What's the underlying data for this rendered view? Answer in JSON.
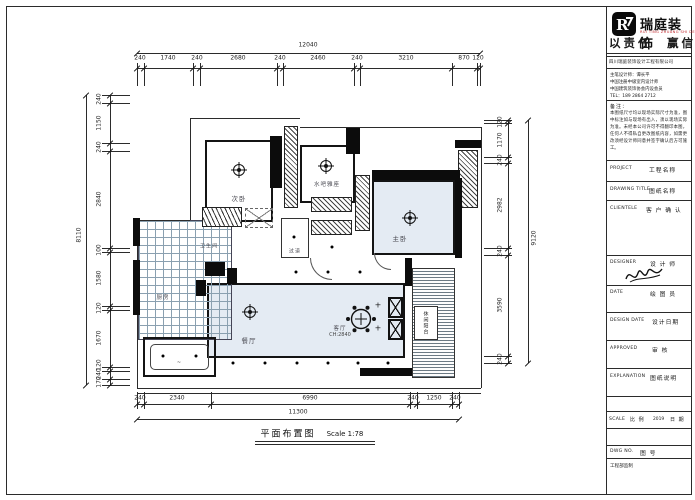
{
  "colors": {
    "room_fill": "#e4ebf3",
    "line": "#1a1a1a",
    "brand_red": "#c1272d"
  },
  "brand": {
    "name": "瑞庭装饰",
    "sub": "RUI TING ZHUANG SHI DECORATION",
    "slogan": "以责任　赢信任",
    "company": "四川瑞庭装饰设计工程有限公司",
    "info": [
      "主笔设计师：谭长平",
      "中国注册中级室内设计师",
      "中国建筑装饰协会内设会员",
      "TEL：189 2864 2712"
    ]
  },
  "titleblock": {
    "notes_label": "备注：",
    "notes": "本图纸尺寸均以现场实际尺寸为准，图中标注如与现场有出入，须以现场实际为准。未经本公司许可不得翻印本图，任何人不得私自更改图纸内容，如需更改须经设计师同意并签字确认后方可施工。",
    "rows": [
      {
        "en": "PROJECT",
        "cn": "工程名称"
      },
      {
        "en": "DRAWING TITLE",
        "cn": "图纸名称"
      },
      {
        "en": "CLIENTELE",
        "cn": "客 户 确 认"
      },
      {
        "en": "DESIGNER",
        "cn": "设 计 师"
      },
      {
        "en": "DATE",
        "cn": "绘 图 员"
      },
      {
        "en": "DESIGN DATE",
        "cn": "设计日期"
      },
      {
        "en": "APPROVED",
        "cn": "审 核"
      },
      {
        "en": "EXPLANATION",
        "cn": "图纸说明"
      },
      {
        "en": "SCALE",
        "cn": "比 例"
      },
      {
        "en": "DWG NO.",
        "cn": "图 号"
      }
    ],
    "scale_year": "2019",
    "scale_date_cn": "日 期",
    "dept": "工程部监制"
  },
  "dims": {
    "top_total": "12040",
    "top": [
      "240",
      "1740",
      "240",
      "2680",
      "240",
      "2460",
      "240",
      "3210",
      "870",
      "120"
    ],
    "left_total": "8110",
    "left": [
      "240",
      "1150",
      "240",
      "2840",
      "100",
      "1580",
      "120",
      "1670",
      "120",
      "240",
      "170"
    ],
    "right_total": "9120",
    "right": [
      "120",
      "1170",
      "240",
      "2982",
      "240",
      "3590",
      "240"
    ],
    "bottom": [
      "240",
      "2340",
      "6990",
      "240",
      "1250",
      "240"
    ],
    "bottom_total": "11300"
  },
  "rooms": {
    "bedroom2": "次卧",
    "waterbar": "水吧雅座",
    "master": "主卧",
    "kitchen": "厨房",
    "bath": "卫生间",
    "hall": "过道",
    "dining": "餐厅",
    "living": "客厅",
    "living_ch": "CH:2840",
    "balcony": "休闲阳台"
  },
  "caption": {
    "title": "平面布置图",
    "scale": "Scale 1:78"
  }
}
